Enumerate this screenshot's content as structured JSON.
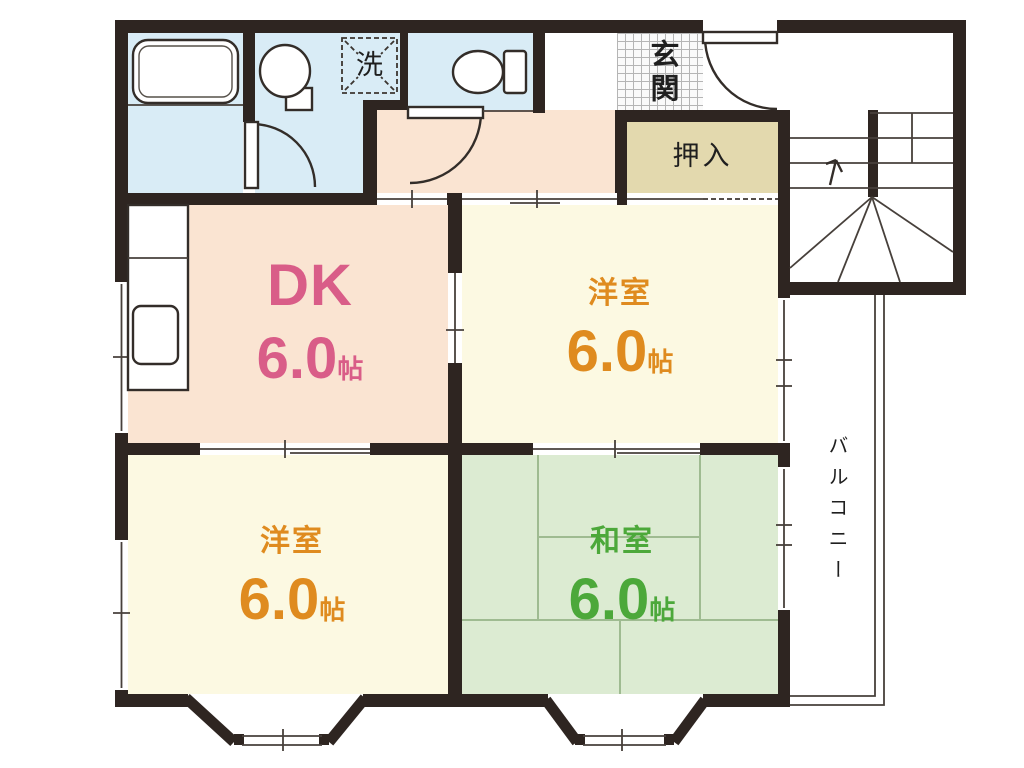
{
  "rooms": {
    "dk": {
      "name": "DK",
      "size": "6.0",
      "unit": "帖"
    },
    "western_top": {
      "name": "洋室",
      "size": "6.0",
      "unit": "帖"
    },
    "western_bottom": {
      "name": "洋室",
      "size": "6.0",
      "unit": "帖"
    },
    "japanese": {
      "name": "和室",
      "size": "6.0",
      "unit": "帖"
    }
  },
  "labels": {
    "entrance": "玄関",
    "closet": "押入",
    "balcony": "バルコニー",
    "laundry": "洗"
  },
  "colors": {
    "wall": "#2e2521",
    "dk_fill": "#fae4d2",
    "western_fill": "#fcf9e2",
    "japanese_fill": "#dcebd2",
    "sanitary_fill": "#d9ecf6",
    "closet_fill": "#e3d9ae",
    "dk_text": "#d95d88",
    "western_text": "#df8b1f",
    "japanese_text": "#4ca83a",
    "label_text": "#1f1f1f"
  }
}
